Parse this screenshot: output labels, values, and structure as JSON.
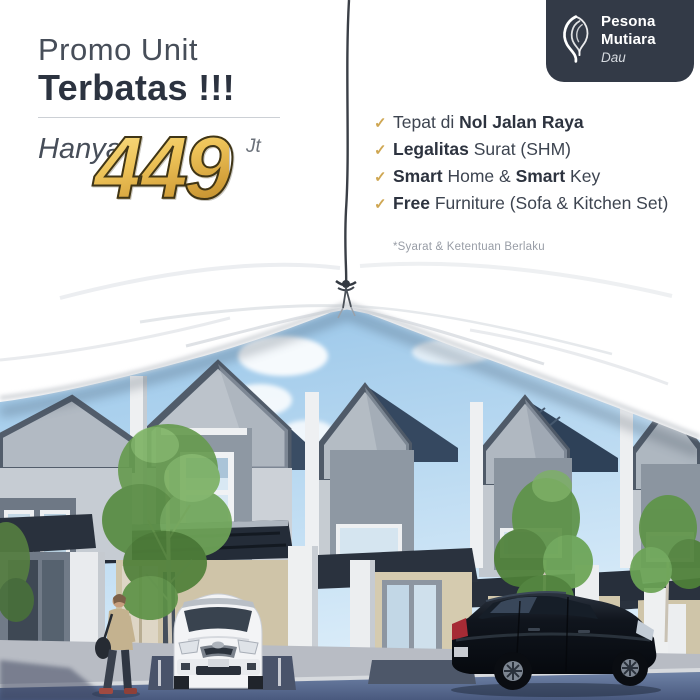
{
  "promo": {
    "title_line1": "Promo Unit",
    "title_line2": "Terbatas !!!",
    "price_prefix": "Hanya",
    "price_value": "449",
    "price_unit": "Jt"
  },
  "brand": {
    "line1": "Pesona",
    "line2": "Mutiara",
    "line3": "Dau",
    "logo_icon": "pearl-swirl",
    "badge_bg": "#333a47"
  },
  "features": {
    "check_glyph": "✓",
    "check_color": "#cfa753",
    "items": [
      {
        "segments": [
          {
            "t": "Tepat di ",
            "bold": false
          },
          {
            "t": "Nol Jalan Raya",
            "bold": true
          }
        ]
      },
      {
        "segments": [
          {
            "t": "Legalitas",
            "bold": true
          },
          {
            "t": " Surat (SHM)",
            "bold": false
          }
        ]
      },
      {
        "segments": [
          {
            "t": "Smart",
            "bold": true
          },
          {
            "t": " Home & ",
            "bold": false
          },
          {
            "t": "Smart",
            "bold": true
          },
          {
            "t": " Key",
            "bold": false
          }
        ]
      },
      {
        "segments": [
          {
            "t": "Free",
            "bold": true
          },
          {
            "t": " Furniture (Sofa & Kitchen Set)",
            "bold": false
          }
        ]
      }
    ]
  },
  "disclaimer": "*Syarat & Ketentuan Berlaku",
  "colors": {
    "accent_gold": "#e0b04a",
    "heading_dark": "#2c3340",
    "body_text": "#3d4450",
    "sky_blue": "#a9cfec",
    "road_blue": "#5d7296"
  }
}
